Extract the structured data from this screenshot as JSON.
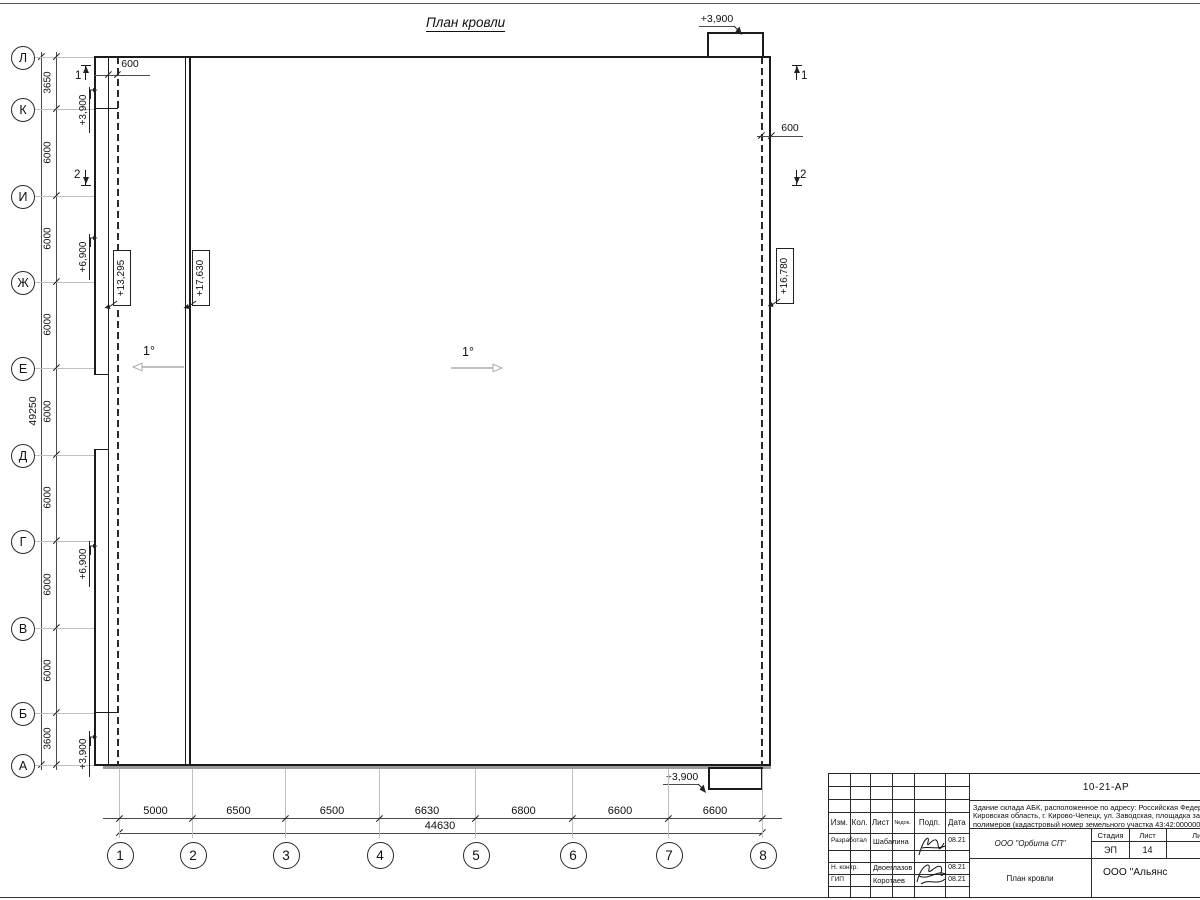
{
  "sheet": {
    "title": "План кровли"
  },
  "row_axes": [
    {
      "label": "Л",
      "y": 57
    },
    {
      "label": "К",
      "y": 109
    },
    {
      "label": "И",
      "y": 196
    },
    {
      "label": "Ж",
      "y": 282
    },
    {
      "label": "Е",
      "y": 368
    },
    {
      "label": "Д",
      "y": 455
    },
    {
      "label": "Г",
      "y": 541
    },
    {
      "label": "В",
      "y": 628
    },
    {
      "label": "Б",
      "y": 713
    },
    {
      "label": "А",
      "y": 765
    }
  ],
  "row_dims": [
    "3650",
    "6000",
    "6000",
    "6000",
    "6000",
    "6000",
    "6000",
    "6000",
    "3600"
  ],
  "row_total": "49250",
  "col_axes": [
    {
      "label": "1",
      "x": 119
    },
    {
      "label": "2",
      "x": 192
    },
    {
      "label": "3",
      "x": 285
    },
    {
      "label": "4",
      "x": 379
    },
    {
      "label": "5",
      "x": 475
    },
    {
      "label": "6",
      "x": 572
    },
    {
      "label": "7",
      "x": 668
    },
    {
      "label": "8",
      "x": 762
    }
  ],
  "col_dims": [
    "5000",
    "6500",
    "6500",
    "6630",
    "6800",
    "6600",
    "6600"
  ],
  "col_total": "44630",
  "offset_dims": {
    "left": "600",
    "right": "600"
  },
  "slopes": {
    "left": "1°",
    "center": "1°"
  },
  "sections": {
    "top_left": "1",
    "mid_left": "2",
    "top_right": "1",
    "mid_right": "2"
  },
  "elevations": {
    "wall_marks": [
      {
        "value": "+3,900",
        "y": 110,
        "ay": 89
      },
      {
        "value": "+6,900",
        "y": 257,
        "ay": 237
      },
      {
        "value": "+6,900",
        "y": 564,
        "ay": 545
      },
      {
        "value": "+3,900",
        "y": 754,
        "ay": 736
      }
    ],
    "boxed": [
      {
        "value": "+13,295",
        "x": 121,
        "y": 277
      },
      {
        "value": "+17,630",
        "x": 200,
        "y": 277
      },
      {
        "value": "+16,780",
        "x": 784,
        "y": 275
      }
    ],
    "canopy_top": "+3,900",
    "canopy_bottom": "+3,900"
  },
  "titleblock": {
    "doc_number": "10-21-АР",
    "description_line1": "Здание склада АБК, расположенное по адресу: Российская Федерация,",
    "description_line2": "Кировская область, г. Кирово-Чепецк, ул. Заводская, площадка завода",
    "description_line3": "полимеров (кадастровый номер земельного участка 43:42:000000:",
    "columns": {
      "izm": "Изм.",
      "kol": "Кол.",
      "list": "Лист",
      "ndok": "№док.",
      "podp": "Подп.",
      "data": "Дата"
    },
    "rows": [
      {
        "role": "Разработал",
        "name": "Шабалина",
        "date": "08.21"
      },
      {
        "role": "Н. контр.",
        "name": "Двоеглазов",
        "date": "08.21"
      },
      {
        "role": "ГИП",
        "name": "Коротаев",
        "date": "08.21"
      }
    ],
    "company": "ООО \"Орбита СП\"",
    "stage_label": "Стадия",
    "sheet_label": "Лист",
    "sheets_label": "Листов",
    "stage": "ЭП",
    "sheet_num": "14",
    "sheets_total": "17",
    "drawing_title": "План кровли",
    "org": "ООО \"Альянс"
  }
}
